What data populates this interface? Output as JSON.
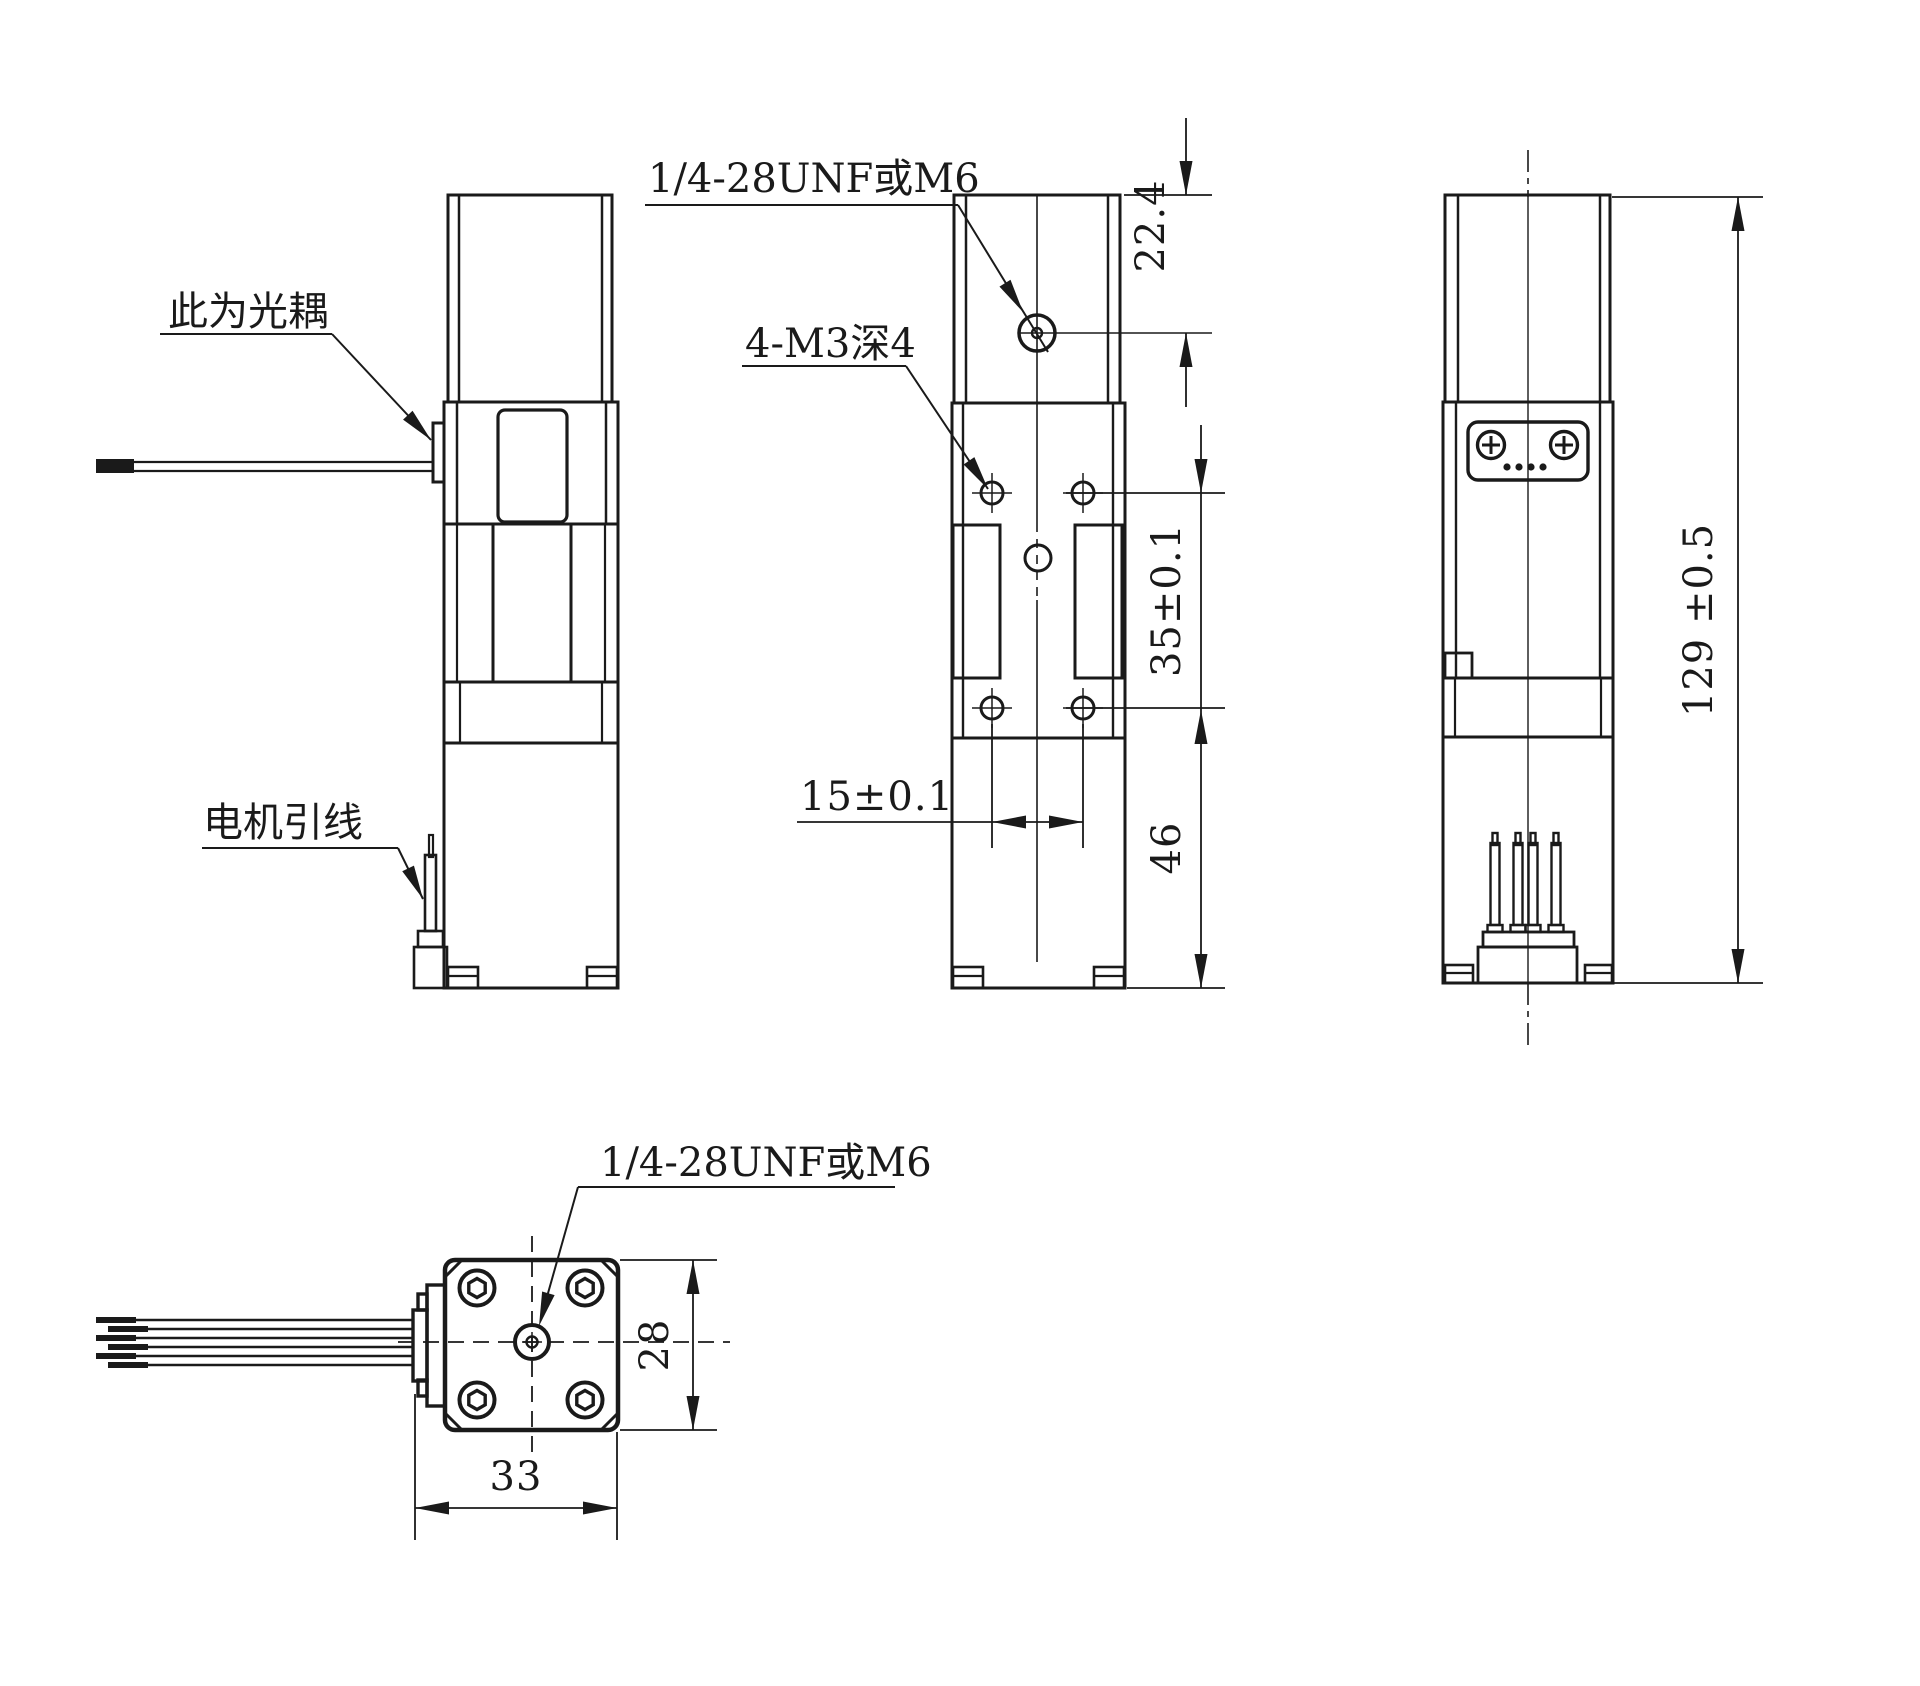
{
  "drawing": {
    "background": "#ffffff",
    "line_color": "#1a1a1a",
    "labels": {
      "optocoupler": "此为光耦",
      "motor_leads": "电机引线",
      "thread_top": "1/4-28UNF或M6",
      "m3_holes": "4-M3深4",
      "thread_bottom": "1/4-28UNF或M6"
    },
    "dimensions": {
      "d22_4": "22.4",
      "d35": "35±0.1",
      "d46": "46",
      "d15": "15±0.1",
      "d129": "129 ±0.5",
      "d28": "28",
      "d33": "33"
    }
  }
}
